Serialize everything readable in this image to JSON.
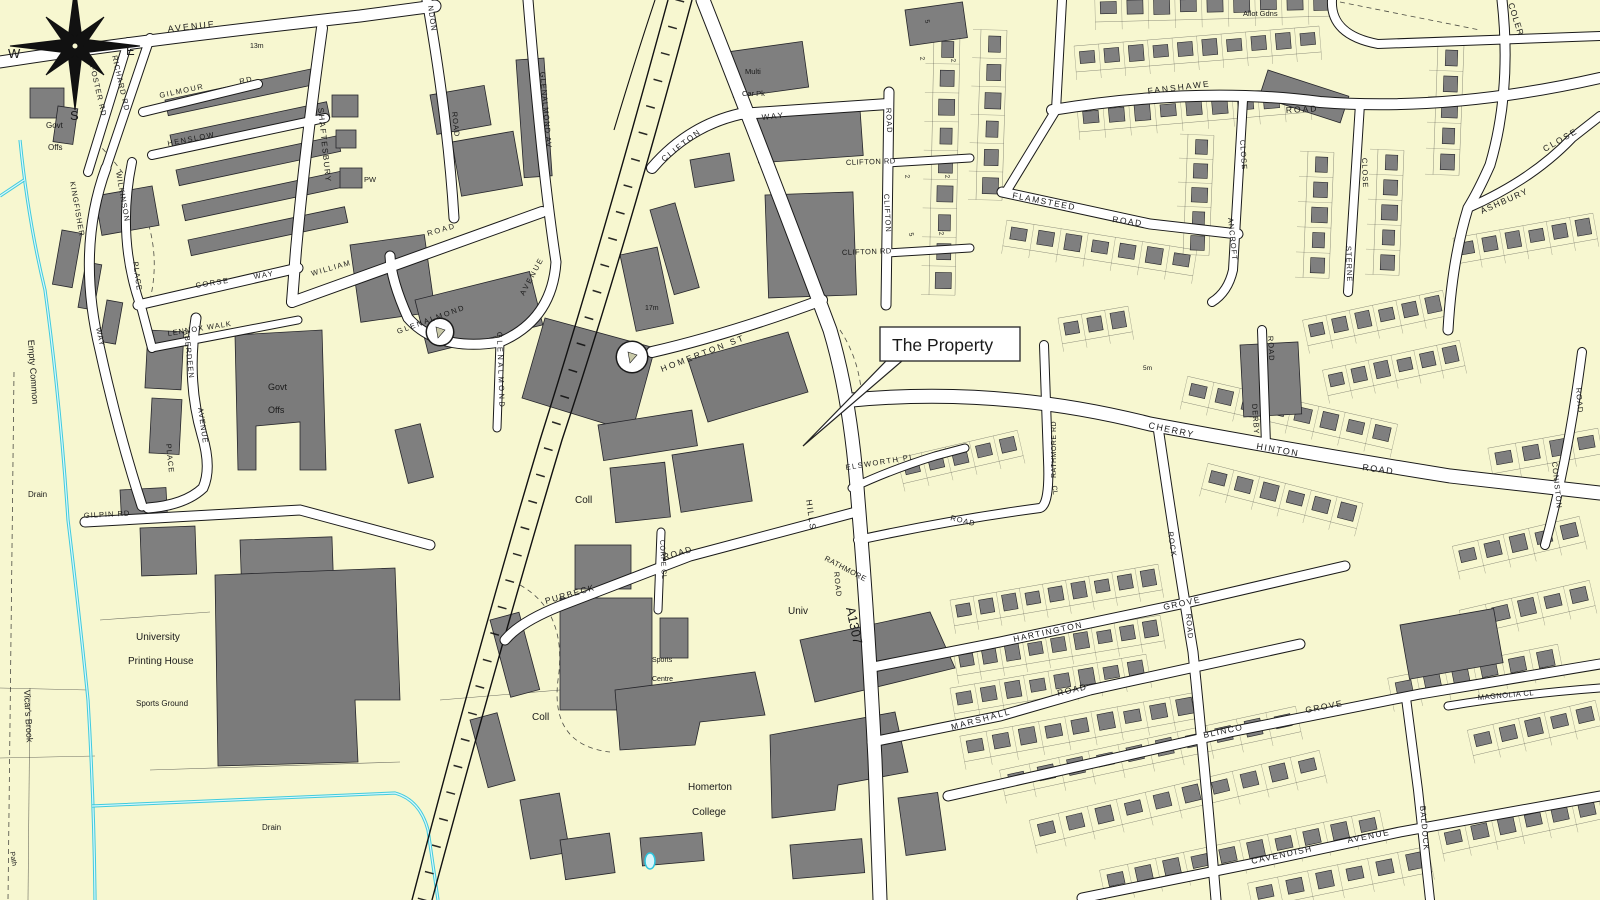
{
  "map_title": "Ordnance-Survey style street map extract",
  "compass": {
    "w": "W",
    "e": "E",
    "s": "S"
  },
  "callout": {
    "text": "The Property"
  },
  "colors": {
    "background": "#f7f7d0",
    "building": "#7f7f7f",
    "road": "#ffffff",
    "water": "#2cc5de",
    "ink": "#1a1a1a"
  },
  "labels": [
    {
      "t": "AVENUE",
      "x": 168,
      "y": 32,
      "r": -6,
      "s": 9,
      "sp": 2
    },
    {
      "t": "13m",
      "x": 250,
      "y": 48,
      "r": 0,
      "s": 7
    },
    {
      "t": "FOSTER RD",
      "x": 90,
      "y": 66,
      "r": 77,
      "s": 7.5,
      "sp": 1
    },
    {
      "t": "RICHARD RD",
      "x": 112,
      "y": 56,
      "r": 77,
      "s": 7.5,
      "sp": 1
    },
    {
      "t": "GILMOUR",
      "x": 160,
      "y": 98,
      "r": -12,
      "s": 7.5,
      "sp": 1.5
    },
    {
      "t": "RD",
      "x": 240,
      "y": 84,
      "r": -12,
      "s": 7.5,
      "sp": 1.5
    },
    {
      "t": "HENSLOW",
      "x": 168,
      "y": 146,
      "r": -11,
      "s": 7.5,
      "sp": 1.5
    },
    {
      "t": "SHAFTESBURY",
      "x": 318,
      "y": 108,
      "r": 84,
      "s": 8,
      "sp": 1.5
    },
    {
      "t": "KINGFISHER",
      "x": 70,
      "y": 182,
      "r": 80,
      "s": 7.5,
      "sp": 1
    },
    {
      "t": "WILKINSON",
      "x": 116,
      "y": 172,
      "r": 80,
      "s": 7.5,
      "sp": 1
    },
    {
      "t": "PLACE",
      "x": 133,
      "y": 262,
      "r": 82,
      "s": 7.5,
      "sp": 1
    },
    {
      "t": "WAY",
      "x": 96,
      "y": 328,
      "r": 78,
      "s": 7.5,
      "sp": 1
    },
    {
      "t": "CORSE",
      "x": 196,
      "y": 288,
      "r": -9,
      "s": 7.5,
      "sp": 1.5
    },
    {
      "t": "WAY",
      "x": 254,
      "y": 279,
      "r": -9,
      "s": 7.5,
      "sp": 1.5
    },
    {
      "t": "LENNOX WALK",
      "x": 168,
      "y": 336,
      "r": -9,
      "s": 7.5,
      "sp": 1
    },
    {
      "t": "ABERDEEN",
      "x": 184,
      "y": 330,
      "r": 84,
      "s": 7.5,
      "sp": 1
    },
    {
      "t": "AVENUE",
      "x": 198,
      "y": 408,
      "r": 82,
      "s": 7.5,
      "sp": 1
    },
    {
      "t": "PLACE",
      "x": 166,
      "y": 444,
      "r": 84,
      "s": 7.5,
      "sp": 1
    },
    {
      "t": "GILPIN RD",
      "x": 84,
      "y": 518,
      "r": -3,
      "s": 7.5,
      "sp": 1
    },
    {
      "t": "Govt",
      "x": 46,
      "y": 128,
      "r": 0,
      "s": 8
    },
    {
      "t": "Offs",
      "x": 48,
      "y": 150,
      "r": 0,
      "s": 8
    },
    {
      "t": "Govt",
      "x": 268,
      "y": 390,
      "r": 0,
      "s": 9
    },
    {
      "t": "Offs",
      "x": 268,
      "y": 413,
      "r": 0,
      "s": 9
    },
    {
      "t": "Empty Common",
      "x": 28,
      "y": 340,
      "r": 86,
      "s": 9,
      "c": "#333333"
    },
    {
      "t": "Drain",
      "x": 28,
      "y": 497,
      "r": 0,
      "s": 8,
      "c": "#333333"
    },
    {
      "t": "Vicar's Brook",
      "x": 24,
      "y": 690,
      "r": 87,
      "s": 9,
      "c": "#333333"
    },
    {
      "t": "Path",
      "x": 10,
      "y": 852,
      "r": 80,
      "s": 7,
      "c": "#333333"
    },
    {
      "t": "University",
      "x": 136,
      "y": 640,
      "r": 0,
      "s": 10
    },
    {
      "t": "Printing House",
      "x": 128,
      "y": 664,
      "r": 0,
      "s": 10
    },
    {
      "t": "Sports Ground",
      "x": 136,
      "y": 706,
      "r": 0,
      "s": 8,
      "c": "#444444"
    },
    {
      "t": "Drain",
      "x": 262,
      "y": 830,
      "r": 0,
      "s": 8,
      "c": "#333333"
    },
    {
      "t": "NDON",
      "x": 428,
      "y": 6,
      "r": 82,
      "s": 7.5,
      "sp": 1
    },
    {
      "t": "ROAD",
      "x": 452,
      "y": 112,
      "r": 84,
      "s": 7.5,
      "sp": 1
    },
    {
      "t": "PW",
      "x": 364,
      "y": 182,
      "r": 0,
      "s": 7.5,
      "c": "#444444"
    },
    {
      "t": "WILLIAM",
      "x": 312,
      "y": 276,
      "r": -16,
      "s": 7.5,
      "sp": 1.5
    },
    {
      "t": "ROAD",
      "x": 428,
      "y": 236,
      "r": -16,
      "s": 7.5,
      "sp": 2
    },
    {
      "t": "GLENALMOND AV",
      "x": 540,
      "y": 72,
      "r": 85,
      "s": 7.5,
      "sp": 1
    },
    {
      "t": "GLENALMOND",
      "x": 398,
      "y": 334,
      "r": -20,
      "s": 7.5,
      "sp": 2
    },
    {
      "t": "AVENUE",
      "x": 524,
      "y": 296,
      "r": -62,
      "s": 7.5,
      "sp": 2
    },
    {
      "t": "GLENALMOND",
      "x": 497,
      "y": 332,
      "r": 88,
      "s": 7.5,
      "sp": 2.5
    },
    {
      "t": "17m",
      "x": 645,
      "y": 310,
      "r": 0,
      "s": 7
    },
    {
      "t": "Multi",
      "x": 745,
      "y": 74,
      "r": 0,
      "s": 7.5,
      "c": "#444444"
    },
    {
      "t": "Car Pk",
      "x": 742,
      "y": 96,
      "r": 0,
      "s": 7.5,
      "c": "#444444"
    },
    {
      "t": "CLIFTON",
      "x": 664,
      "y": 162,
      "r": -38,
      "s": 8,
      "sp": 2
    },
    {
      "t": "WAY",
      "x": 762,
      "y": 120,
      "r": -6,
      "s": 8,
      "sp": 2
    },
    {
      "t": "ROAD",
      "x": 886,
      "y": 108,
      "r": 87,
      "s": 7.5,
      "sp": 1
    },
    {
      "t": "CLIFTON RD",
      "x": 846,
      "y": 165,
      "r": -2,
      "s": 7.5,
      "sp": 0.5
    },
    {
      "t": "CLIFTON",
      "x": 884,
      "y": 194,
      "r": 87,
      "s": 7.5,
      "sp": 1
    },
    {
      "t": "CLIFTON RD",
      "x": 842,
      "y": 255,
      "r": -2,
      "s": 7.5,
      "sp": 0.5
    },
    {
      "t": "5",
      "x": 925,
      "y": 20,
      "r": 80,
      "s": 6.5
    },
    {
      "t": "2",
      "x": 920,
      "y": 57,
      "r": 80,
      "s": 6.5
    },
    {
      "t": "2",
      "x": 951,
      "y": 59,
      "r": 80,
      "s": 6.5
    },
    {
      "t": "2",
      "x": 905,
      "y": 175,
      "r": 80,
      "s": 6.5
    },
    {
      "t": "2",
      "x": 945,
      "y": 175,
      "r": 80,
      "s": 6.5
    },
    {
      "t": "5",
      "x": 909,
      "y": 233,
      "r": 80,
      "s": 6.5
    },
    {
      "t": "2",
      "x": 939,
      "y": 232,
      "r": 80,
      "s": 6.5
    },
    {
      "t": "Allot Gdns",
      "x": 1243,
      "y": 16,
      "r": 0,
      "s": 7.5,
      "c": "#444444"
    },
    {
      "t": "FANSHAWE",
      "x": 1148,
      "y": 94,
      "r": -7,
      "s": 8.5,
      "sp": 2
    },
    {
      "t": "ROAD",
      "x": 1286,
      "y": 113,
      "r": -3,
      "s": 8.5,
      "sp": 2
    },
    {
      "t": "FLAMSTEED",
      "x": 1012,
      "y": 198,
      "r": 11,
      "s": 8.5,
      "sp": 1.5
    },
    {
      "t": "ROAD",
      "x": 1112,
      "y": 222,
      "r": 8,
      "s": 8.5,
      "sp": 1.5
    },
    {
      "t": "CLOSE",
      "x": 1240,
      "y": 140,
      "r": 86,
      "s": 7.5,
      "sp": 1
    },
    {
      "t": "ANCROFT",
      "x": 1228,
      "y": 218,
      "r": 84,
      "s": 7.5,
      "sp": 1
    },
    {
      "t": "CLOSE",
      "x": 1362,
      "y": 158,
      "r": 88,
      "s": 7.5,
      "sp": 1
    },
    {
      "t": "STERNE",
      "x": 1346,
      "y": 246,
      "r": 88,
      "s": 7.5,
      "sp": 1
    },
    {
      "t": "COLER",
      "x": 1508,
      "y": 4,
      "r": 72,
      "s": 8.5,
      "sp": 1
    },
    {
      "t": "ASHBURY",
      "x": 1482,
      "y": 214,
      "r": -24,
      "s": 8.5,
      "sp": 1.5
    },
    {
      "t": "CLOSE",
      "x": 1545,
      "y": 152,
      "r": -30,
      "s": 8.5,
      "sp": 2
    },
    {
      "t": "CHERRY",
      "x": 1148,
      "y": 428,
      "r": 12,
      "s": 9,
      "sp": 1.5
    },
    {
      "t": "HINTON",
      "x": 1256,
      "y": 449,
      "r": 10,
      "s": 9,
      "sp": 1.5
    },
    {
      "t": "ROAD",
      "x": 1362,
      "y": 470,
      "r": 8,
      "s": 9,
      "sp": 1.5
    },
    {
      "t": "ROAD",
      "x": 1268,
      "y": 336,
      "r": 87,
      "s": 7.5,
      "sp": 1
    },
    {
      "t": "DERBY",
      "x": 1252,
      "y": 404,
      "r": 86,
      "s": 7.5,
      "sp": 1
    },
    {
      "t": "5m",
      "x": 1143,
      "y": 370,
      "r": 0,
      "s": 6.5,
      "c": "#3f7d3f"
    },
    {
      "t": "RATHMORE RD",
      "x": 1056,
      "y": 478,
      "r": -90,
      "s": 7,
      "sp": 0.5
    },
    {
      "t": "CL",
      "x": 1052,
      "y": 486,
      "r": 80,
      "s": 7
    },
    {
      "t": "ELSWORTH PL",
      "x": 846,
      "y": 470,
      "r": -9,
      "s": 7.5,
      "sp": 1.5
    },
    {
      "t": "HILLS",
      "x": 806,
      "y": 500,
      "r": 82,
      "s": 8.5,
      "sp": 1.5
    },
    {
      "t": "RATHMORE",
      "x": 824,
      "y": 560,
      "r": 28,
      "s": 7.5,
      "sp": 0.5
    },
    {
      "t": "ROAD",
      "x": 834,
      "y": 572,
      "r": 84,
      "s": 7.5,
      "sp": 1
    },
    {
      "t": "A1307",
      "x": 846,
      "y": 608,
      "r": 78,
      "s": 13
    },
    {
      "t": "ROAD",
      "x": 950,
      "y": 520,
      "r": 14,
      "s": 7.5,
      "sp": 1
    },
    {
      "t": "Univ",
      "x": 788,
      "y": 614,
      "r": 0,
      "s": 10
    },
    {
      "t": "PURBECK",
      "x": 546,
      "y": 604,
      "r": -16,
      "s": 8.5,
      "sp": 1.5
    },
    {
      "t": "ROAD",
      "x": 664,
      "y": 560,
      "r": -16,
      "s": 8.5,
      "sp": 1.5
    },
    {
      "t": "CORFE CL",
      "x": 660,
      "y": 540,
      "r": 87,
      "s": 7,
      "sp": 0.5
    },
    {
      "t": "Sports",
      "x": 652,
      "y": 662,
      "r": 0,
      "s": 7,
      "c": "#555555"
    },
    {
      "t": "Centre",
      "x": 652,
      "y": 681,
      "r": 0,
      "s": 7,
      "c": "#555555"
    },
    {
      "t": "Coll",
      "x": 575,
      "y": 503,
      "r": 0,
      "s": 10
    },
    {
      "t": "Coll",
      "x": 532,
      "y": 720,
      "r": 0,
      "s": 10
    },
    {
      "t": "Homerton",
      "x": 688,
      "y": 790,
      "r": 0,
      "s": 10
    },
    {
      "t": "College",
      "x": 692,
      "y": 815,
      "r": 0,
      "s": 10
    },
    {
      "t": "HOMERTON ST",
      "x": 662,
      "y": 372,
      "r": -21,
      "s": 8.5,
      "sp": 2.5
    },
    {
      "t": "ROCK",
      "x": 1168,
      "y": 532,
      "r": 82,
      "s": 7.5,
      "sp": 1
    },
    {
      "t": "HARTINGTON",
      "x": 1014,
      "y": 642,
      "r": -12,
      "s": 8.5,
      "sp": 1.5
    },
    {
      "t": "GROVE",
      "x": 1164,
      "y": 610,
      "r": -12,
      "s": 8.5,
      "sp": 1.5
    },
    {
      "t": "ROAD",
      "x": 1186,
      "y": 614,
      "r": 85,
      "s": 7.5,
      "sp": 1
    },
    {
      "t": "MARSHALL",
      "x": 952,
      "y": 730,
      "r": -15,
      "s": 8.5,
      "sp": 2
    },
    {
      "t": "ROAD",
      "x": 1058,
      "y": 696,
      "r": -13,
      "s": 8.5,
      "sp": 1.5
    },
    {
      "t": "BLINCO",
      "x": 1204,
      "y": 738,
      "r": -12,
      "s": 8.5,
      "sp": 1.5
    },
    {
      "t": "GROVE",
      "x": 1306,
      "y": 713,
      "r": -11,
      "s": 8.5,
      "sp": 1.5
    },
    {
      "t": "CAVENDISH",
      "x": 1252,
      "y": 864,
      "r": -12,
      "s": 8.5,
      "sp": 1.5
    },
    {
      "t": "AVENUE",
      "x": 1348,
      "y": 843,
      "r": -11,
      "s": 8.5,
      "sp": 1.5
    },
    {
      "t": "BALDOCK",
      "x": 1420,
      "y": 806,
      "r": 85,
      "s": 8,
      "sp": 1
    },
    {
      "t": "MAGNOLIA CL",
      "x": 1478,
      "y": 700,
      "r": -5,
      "s": 7.5,
      "sp": 0.5
    },
    {
      "t": "ROAD",
      "x": 1576,
      "y": 388,
      "r": 85,
      "s": 7.5,
      "sp": 1
    },
    {
      "t": "CONISTON",
      "x": 1552,
      "y": 462,
      "r": 84,
      "s": 7.5,
      "sp": 1
    }
  ]
}
